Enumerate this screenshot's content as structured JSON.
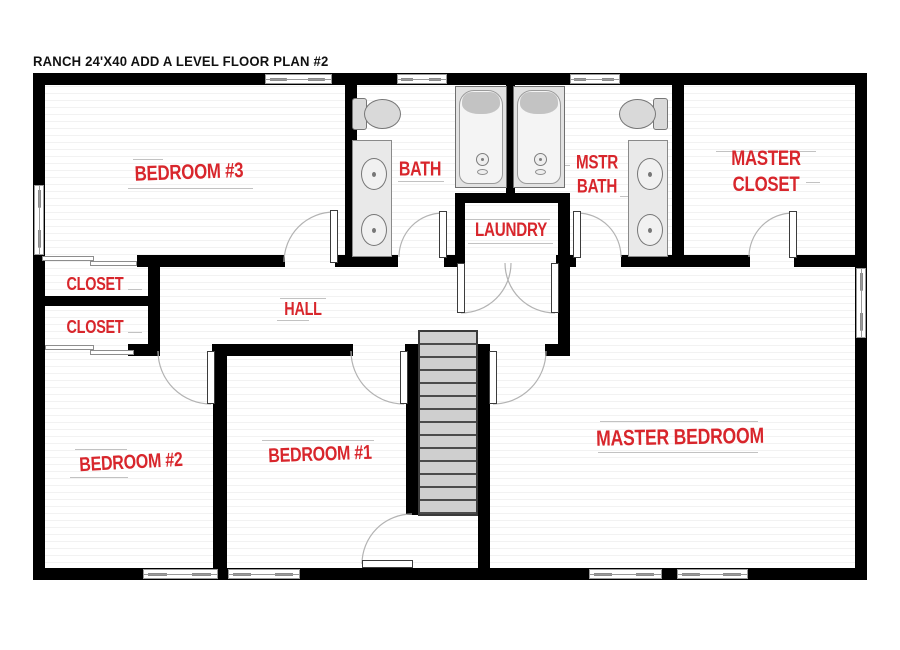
{
  "title": "RANCH 24'X40 ADD A LEVEL FLOOR PLAN #2",
  "colors": {
    "label_red": "#d8262c",
    "wall_black": "#000000",
    "floor_line": "#ececec",
    "fixture_gray": "#d9d9d9",
    "stair_gray": "#cfcfcf",
    "arc_gray": "#b3b3b3"
  },
  "rooms": [
    {
      "id": "bedroom-3",
      "label": "BEDROOM #3"
    },
    {
      "id": "bath",
      "label": "BATH"
    },
    {
      "id": "mstr-bath",
      "label": "MSTR BATH"
    },
    {
      "id": "master-closet",
      "label": "MASTER CLOSET"
    },
    {
      "id": "laundry",
      "label": "LAUNDRY"
    },
    {
      "id": "hall",
      "label": "HALL"
    },
    {
      "id": "closet-upper",
      "label": "CLOSET"
    },
    {
      "id": "closet-lower",
      "label": "CLOSET"
    },
    {
      "id": "bedroom-2",
      "label": "BEDROOM #2"
    },
    {
      "id": "bedroom-1",
      "label": "BEDROOM #1"
    },
    {
      "id": "master-bedroom",
      "label": "MASTER BEDROOM"
    }
  ],
  "fixtures": [
    "toilet",
    "toilet",
    "bathtub",
    "bathtub",
    "double-sink-vanity",
    "double-sink-vanity",
    "staircase",
    "sliding-closet-doors",
    "swing-door",
    "window"
  ]
}
